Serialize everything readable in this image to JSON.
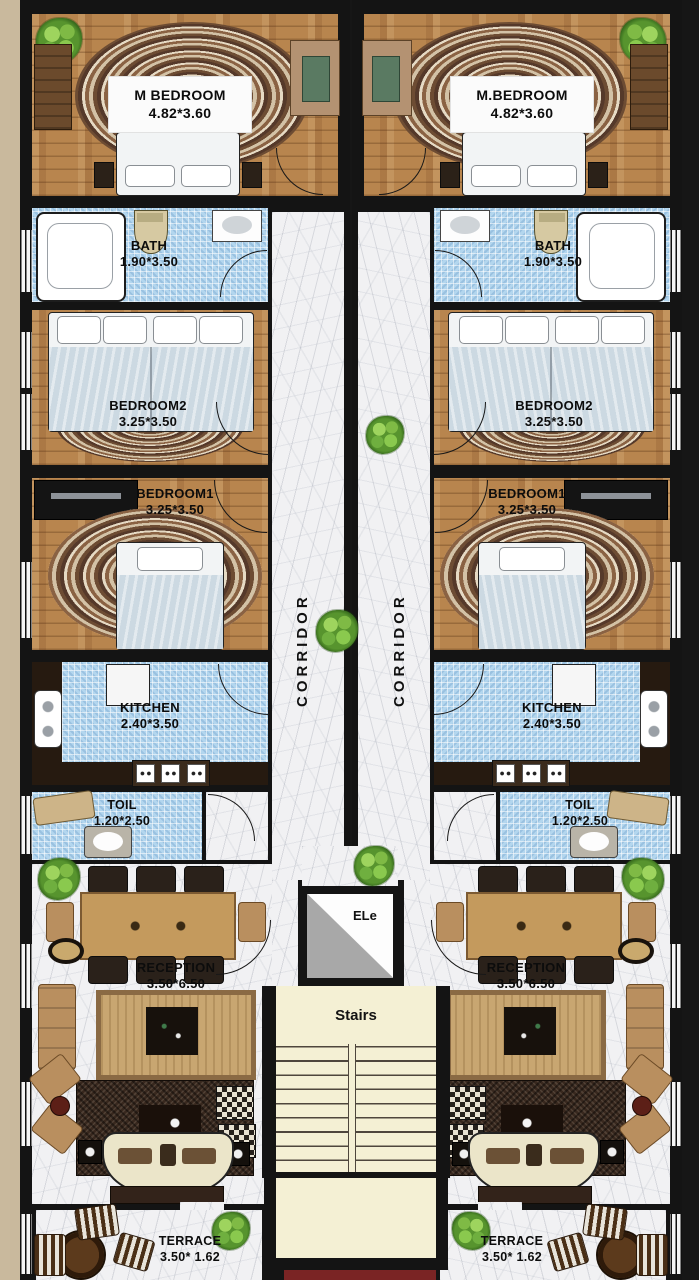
{
  "title": "Residential duplex floor plan",
  "units": {
    "left": {
      "rooms": {
        "m_bedroom": {
          "name": "M BEDROOM",
          "dims": "4.82*3.60"
        },
        "bath": {
          "name": "BATH",
          "dims": "1.90*3.50"
        },
        "bedroom2": {
          "name": "BEDROOM2",
          "dims": "3.25*3.50"
        },
        "bedroom1": {
          "name": "BEDROOM1",
          "dims": "3.25*3.50"
        },
        "kitchen": {
          "name": "KITCHEN",
          "dims": "2.40*3.50"
        },
        "toilet": {
          "name": "TOIL",
          "dims": "1.20*2.50"
        },
        "reception": {
          "name": "RECEPTION",
          "dims": "3.50*6.50"
        },
        "terrace": {
          "name": "TERRACE",
          "dims": "3.50* 1.62"
        }
      },
      "corridor_label": "CORRIDOR"
    },
    "right": {
      "rooms": {
        "m_bedroom": {
          "name": "M.BEDROOM",
          "dims": "4.82*3.60"
        },
        "bath": {
          "name": "BATH",
          "dims": "1.90*3.50"
        },
        "bedroom2": {
          "name": "BEDROOM2",
          "dims": "3.25*3.50"
        },
        "bedroom1": {
          "name": "BEDROOM1",
          "dims": "3.25*3.50"
        },
        "kitchen": {
          "name": "KITCHEN",
          "dims": "2.40*3.50"
        },
        "toilet": {
          "name": "TOIL",
          "dims": "1.20*2.50"
        },
        "reception": {
          "name": "RECEPTION",
          "dims": "3.50*6.50"
        },
        "terrace": {
          "name": "TERRACE",
          "dims": "3.50* 1.62"
        }
      },
      "corridor_label": "CORRIDOR"
    }
  },
  "core": {
    "elevator_label": "ELe",
    "stairs_label": "Stairs"
  },
  "colors": {
    "wall": "#161616",
    "wood_floor": "#b8854e",
    "tile_floor": "#b3d6ee",
    "marble_floor": "#f1f1f3",
    "stairs_cream": "#f4f0d4",
    "bottom_maroon": "#7a2424",
    "margin_beige": "#c9b99d",
    "plant_green": "#57942e",
    "table_tan": "#c49a5d"
  }
}
